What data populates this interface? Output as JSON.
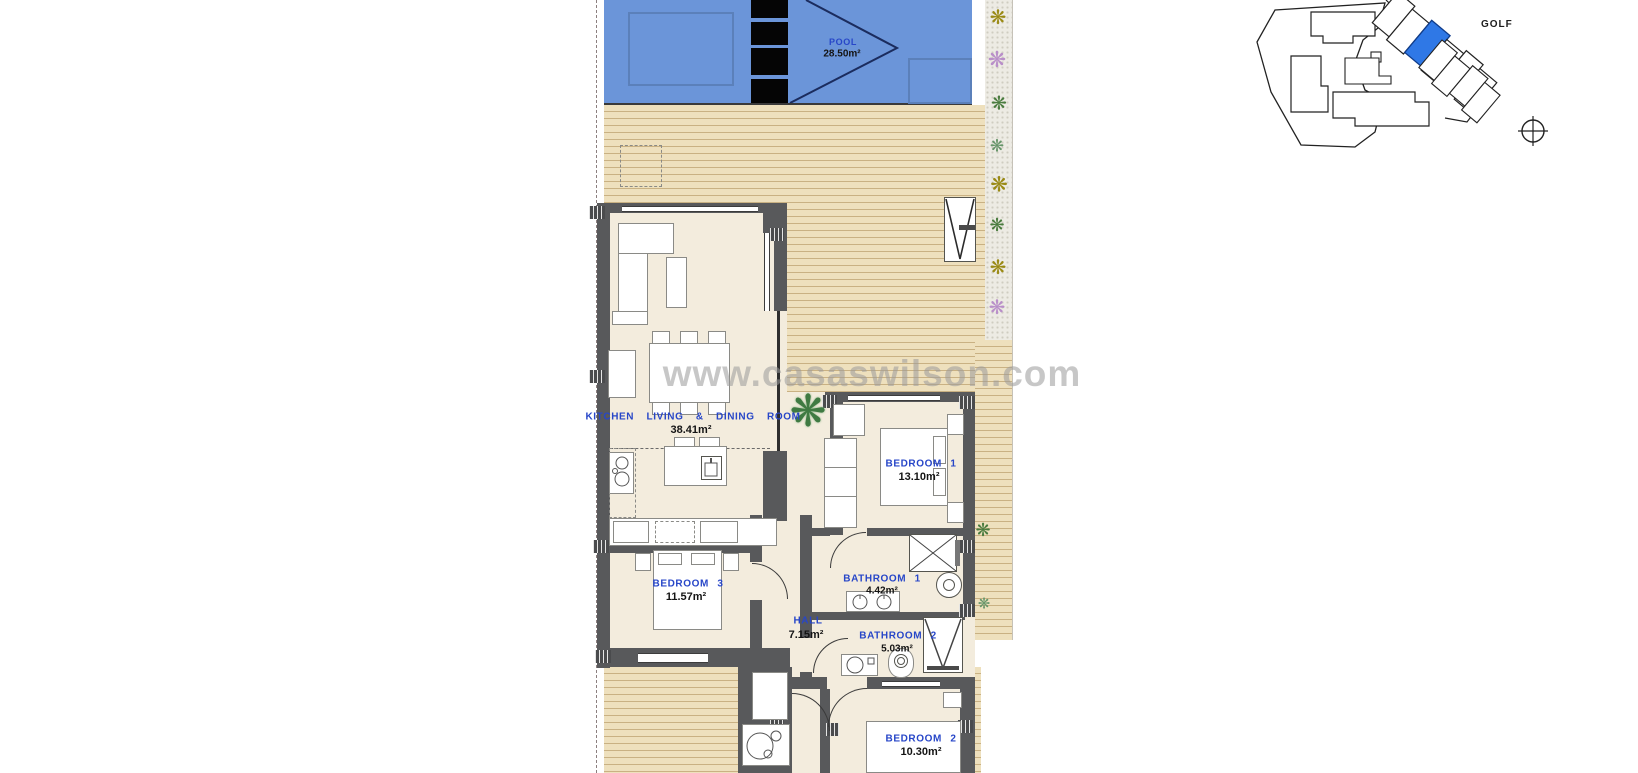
{
  "watermark_text": "www.casaswilson.com",
  "site_plan": {
    "golf_label": "GOLF"
  },
  "pool": {
    "label": "POOL",
    "area": "28.50m²"
  },
  "rooms": {
    "kitchen": {
      "label": "KITCHEN LIVING & DINING ROOM",
      "area": "38.41m²"
    },
    "bedroom1": {
      "label": "BEDROOM 1",
      "area": "13.10m²"
    },
    "bedroom3": {
      "label": "BEDROOM 3",
      "area": "11.57m²"
    },
    "bathroom1": {
      "label": "BATHROOM 1",
      "area": "4.42m²"
    },
    "bathroom2": {
      "label": "BATHROOM 2",
      "area": "5.03m²"
    },
    "hall": {
      "label": "HALL",
      "area": "7.15m²"
    },
    "bedroom2": {
      "label": "BEDROOM 2",
      "area": "10.30m²"
    }
  },
  "icons": {
    "compass": "compass-icon",
    "plants": [
      "olive-plant-icon",
      "purple-plant-icon",
      "green-plant-icon"
    ]
  },
  "colors": {
    "pool_blue": "#6b95d9",
    "deck_tan": "#eee0bd",
    "floor_beige": "#f3ecdd",
    "wall_gray": "#58595b",
    "label_blue": "#2746c8",
    "highlighted_unit_blue": "#2f78e6",
    "plant_olive": "#9a8a15",
    "plant_purple": "#b98fc9",
    "plant_green": "#4a7c3f"
  }
}
